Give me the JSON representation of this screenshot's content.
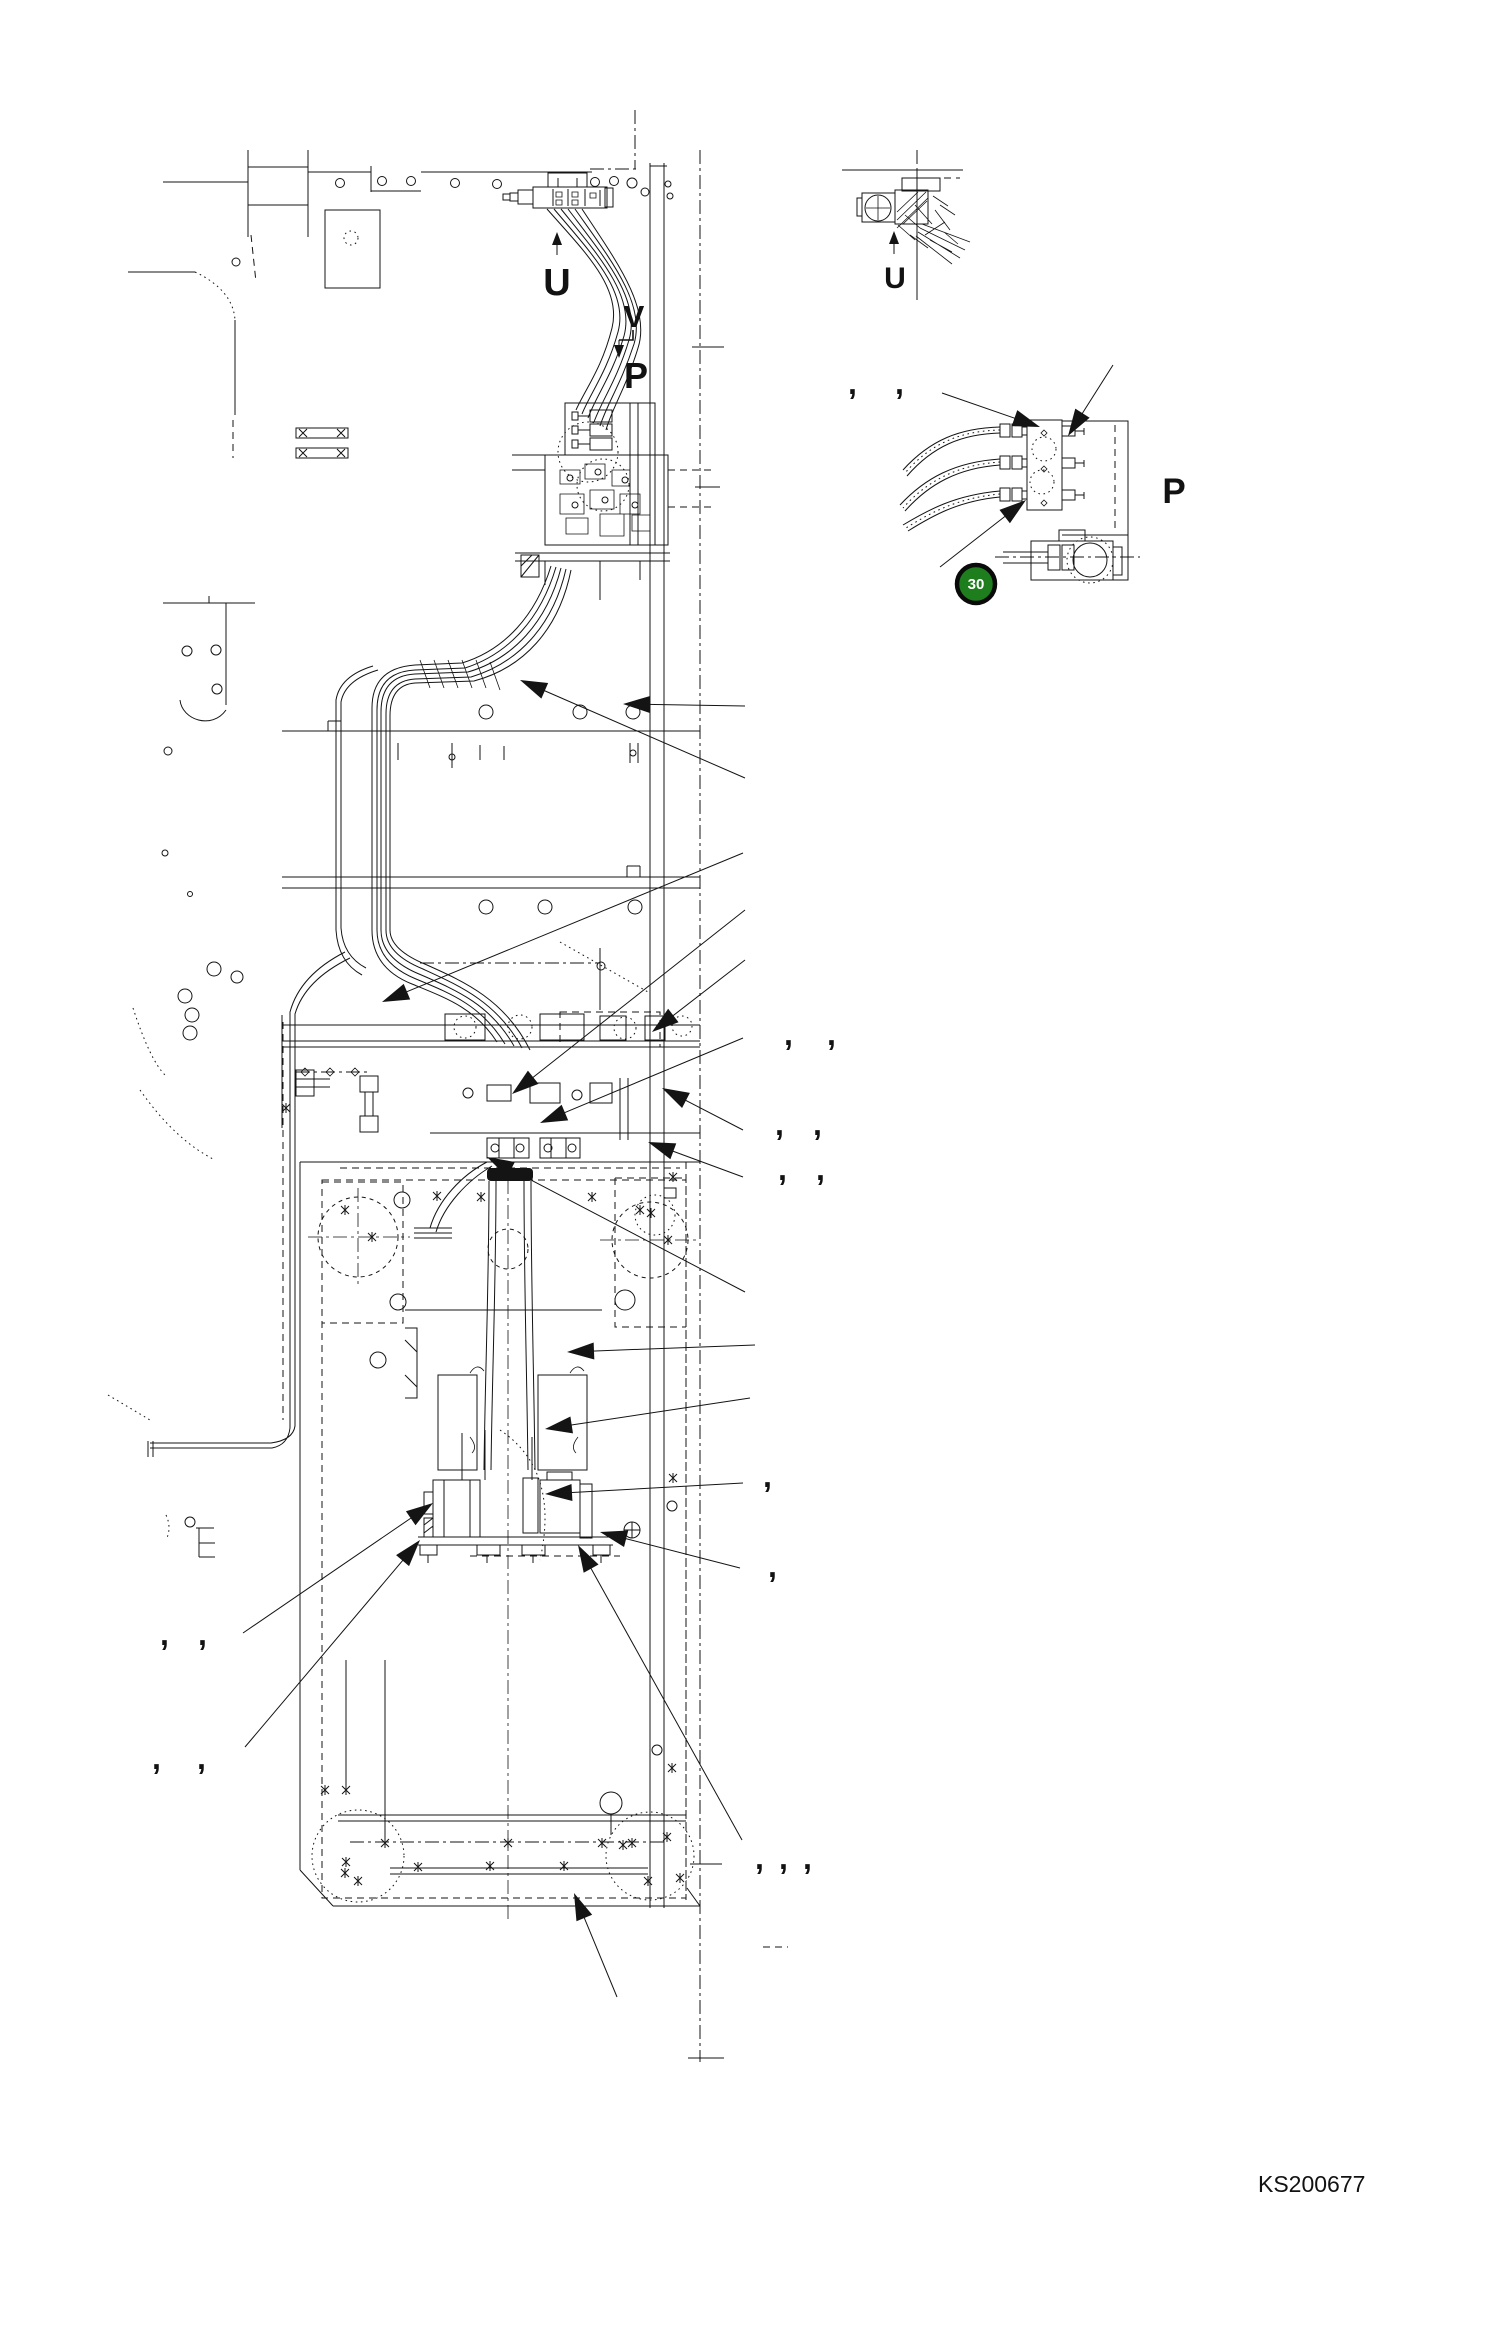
{
  "drawing": {
    "number": "KS200677",
    "number_pos": {
      "x": 1258,
      "y": 2192,
      "size": 23
    },
    "badge": {
      "label": "30",
      "x": 976,
      "y": 584,
      "r": 19,
      "fill_color": "#1e7e1e",
      "ring_color": "#0a0a0a",
      "text_color": "#ffffff"
    }
  },
  "colors": {
    "line": "#141414",
    "background": "#ffffff"
  },
  "view_labels": [
    {
      "id": "view-u-main",
      "text": "U",
      "x": 557,
      "y": 295,
      "size": 38
    },
    {
      "id": "view-v-main",
      "text": "V",
      "x": 634,
      "y": 327,
      "size": 31
    },
    {
      "id": "view-p-main",
      "text": "P",
      "x": 636,
      "y": 388,
      "size": 36
    },
    {
      "id": "view-u-detail",
      "text": "U",
      "x": 895,
      "y": 288,
      "size": 30
    },
    {
      "id": "view-p-detail",
      "text": "P",
      "x": 1174,
      "y": 503,
      "size": 35
    }
  ],
  "section_arrows": [
    {
      "x1": 557,
      "y1": 255,
      "x2": 557,
      "y2": 232
    },
    {
      "x1": 894,
      "y1": 254,
      "x2": 894,
      "y2": 231
    },
    {
      "x1": 619,
      "y1": 340,
      "x2": 619,
      "y2": 358
    }
  ],
  "callout_arrows": [
    {
      "x1": 745,
      "y1": 778,
      "x2": 520,
      "y2": 680
    },
    {
      "x1": 745,
      "y1": 706,
      "x2": 623,
      "y2": 704
    },
    {
      "x1": 743,
      "y1": 853,
      "x2": 382,
      "y2": 1002
    },
    {
      "x1": 745,
      "y1": 910,
      "x2": 512,
      "y2": 1094
    },
    {
      "x1": 745,
      "y1": 960,
      "x2": 652,
      "y2": 1032
    },
    {
      "x1": 743,
      "y1": 1038,
      "x2": 540,
      "y2": 1123
    },
    {
      "x1": 743,
      "y1": 1130,
      "x2": 662,
      "y2": 1088
    },
    {
      "x1": 743,
      "y1": 1177,
      "x2": 648,
      "y2": 1142
    },
    {
      "x1": 745,
      "y1": 1292,
      "x2": 487,
      "y2": 1157
    },
    {
      "x1": 755,
      "y1": 1345,
      "x2": 567,
      "y2": 1352
    },
    {
      "x1": 750,
      "y1": 1398,
      "x2": 545,
      "y2": 1429
    },
    {
      "x1": 743,
      "y1": 1483,
      "x2": 545,
      "y2": 1494
    },
    {
      "x1": 740,
      "y1": 1568,
      "x2": 600,
      "y2": 1532
    },
    {
      "x1": 742,
      "y1": 1840,
      "x2": 578,
      "y2": 1545
    },
    {
      "x1": 617,
      "y1": 1997,
      "x2": 574,
      "y2": 1893
    },
    {
      "x1": 243,
      "y1": 1633,
      "x2": 433,
      "y2": 1503
    },
    {
      "x1": 245,
      "y1": 1747,
      "x2": 420,
      "y2": 1540
    },
    {
      "x1": 942,
      "y1": 393,
      "x2": 1040,
      "y2": 427
    },
    {
      "x1": 1113,
      "y1": 365,
      "x2": 1068,
      "y2": 436
    },
    {
      "x1": 940,
      "y1": 567,
      "x2": 1026,
      "y2": 500
    }
  ],
  "callout_commas": {
    "glyph": ",",
    "size": 32,
    "positions": [
      {
        "x": 848,
        "y": 394
      },
      {
        "x": 895,
        "y": 394
      },
      {
        "x": 784,
        "y": 1045
      },
      {
        "x": 827,
        "y": 1045
      },
      {
        "x": 775,
        "y": 1135
      },
      {
        "x": 813,
        "y": 1135
      },
      {
        "x": 778,
        "y": 1180
      },
      {
        "x": 816,
        "y": 1180
      },
      {
        "x": 763,
        "y": 1487
      },
      {
        "x": 768,
        "y": 1577
      },
      {
        "x": 755,
        "y": 1869
      },
      {
        "x": 779,
        "y": 1869
      },
      {
        "x": 803,
        "y": 1869
      },
      {
        "x": 160,
        "y": 1645
      },
      {
        "x": 198,
        "y": 1645
      },
      {
        "x": 152,
        "y": 1769
      },
      {
        "x": 197,
        "y": 1769
      }
    ]
  },
  "marks": {
    "asterisks": [
      {
        "x": 437,
        "y": 1196
      },
      {
        "x": 481,
        "y": 1197
      },
      {
        "x": 592,
        "y": 1197
      },
      {
        "x": 651,
        "y": 1213
      },
      {
        "x": 673,
        "y": 1177
      },
      {
        "x": 286,
        "y": 1108
      },
      {
        "x": 325,
        "y": 1790
      },
      {
        "x": 346,
        "y": 1862
      },
      {
        "x": 358,
        "y": 1881
      },
      {
        "x": 418,
        "y": 1867
      },
      {
        "x": 490,
        "y": 1866
      },
      {
        "x": 564,
        "y": 1866
      },
      {
        "x": 602,
        "y": 1843
      },
      {
        "x": 648,
        "y": 1881
      },
      {
        "x": 623,
        "y": 1845
      },
      {
        "x": 667,
        "y": 1837
      },
      {
        "x": 680,
        "y": 1878
      },
      {
        "x": 345,
        "y": 1873
      },
      {
        "x": 385,
        "y": 1843
      },
      {
        "x": 508,
        "y": 1843
      },
      {
        "x": 632,
        "y": 1843
      },
      {
        "x": 672,
        "y": 1768
      },
      {
        "x": 346,
        "y": 1790
      },
      {
        "x": 673,
        "y": 1478
      },
      {
        "x": 345,
        "y": 1210
      },
      {
        "x": 372,
        "y": 1237
      },
      {
        "x": 640,
        "y": 1210
      },
      {
        "x": 668,
        "y": 1240
      }
    ]
  }
}
